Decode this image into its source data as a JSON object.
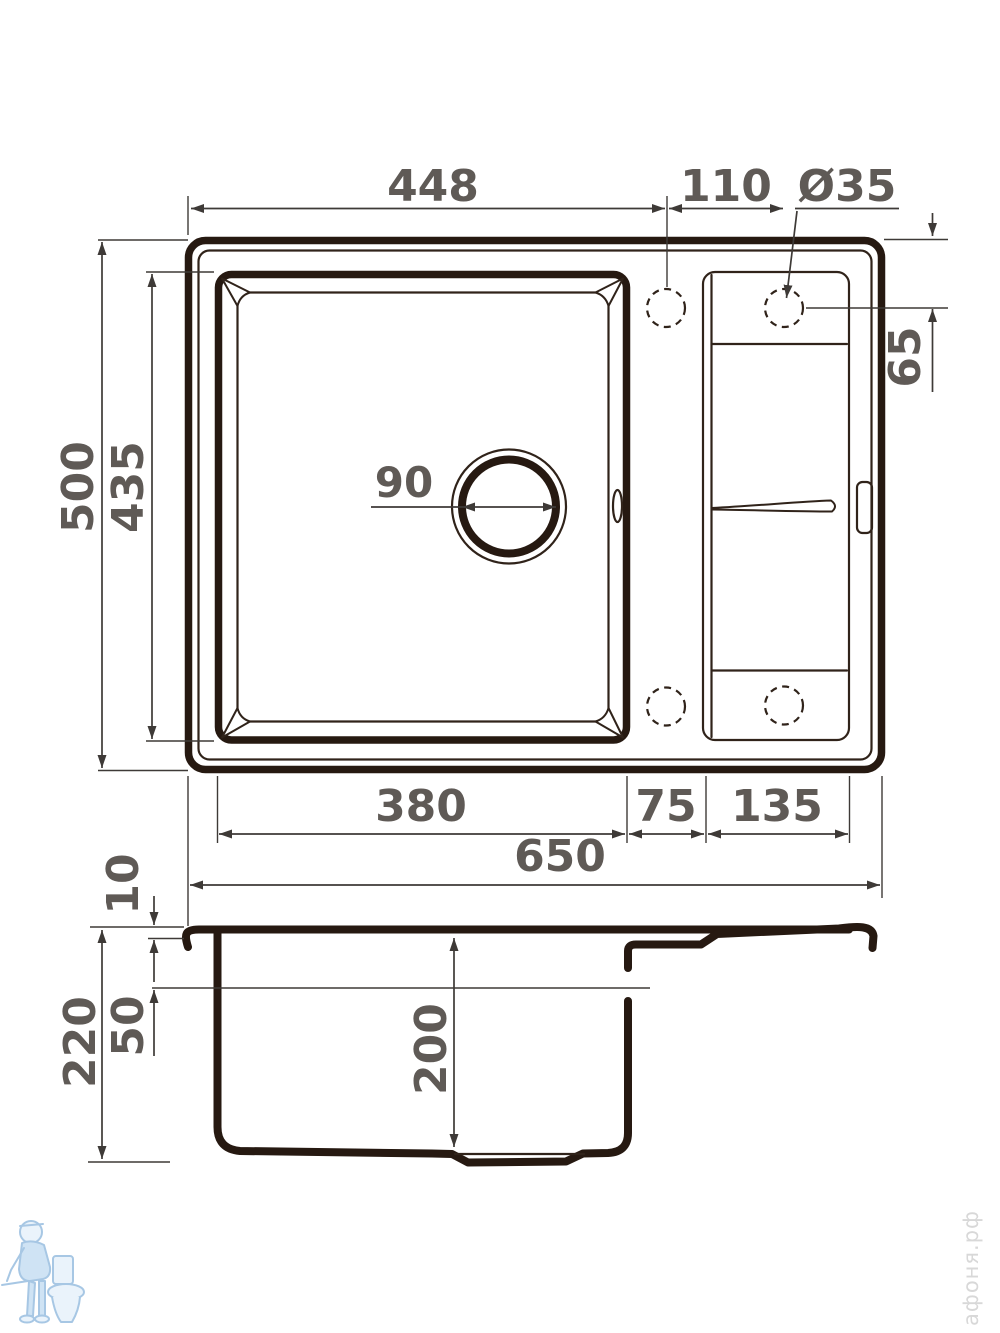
{
  "colors": {
    "ink": "#261911",
    "ink2": "#30231a",
    "dim": "#3e3a37",
    "label": "#5f5a56",
    "wm-gray": "#d8d8d8",
    "wm-stroke": "#a7c7e4",
    "wm-fill": "#cfe3f4"
  },
  "top_view": {
    "dims": {
      "top_width": "448",
      "hole_spacing": "110",
      "hole_diameter": "Ø35",
      "hole_center_offset": "65",
      "overall_depth": "500",
      "bowl_inner_depth": "435",
      "drain_diameter": "90",
      "bowl_width": "380",
      "ledge_width": "75",
      "drainboard_width": "135",
      "overall_width": "650"
    }
  },
  "side_view": {
    "dims": {
      "rim_height": "10",
      "drainboard_depth": "50",
      "overall_height": "220",
      "bowl_depth": "200"
    }
  },
  "watermark": {
    "site": "афоня.рф"
  }
}
